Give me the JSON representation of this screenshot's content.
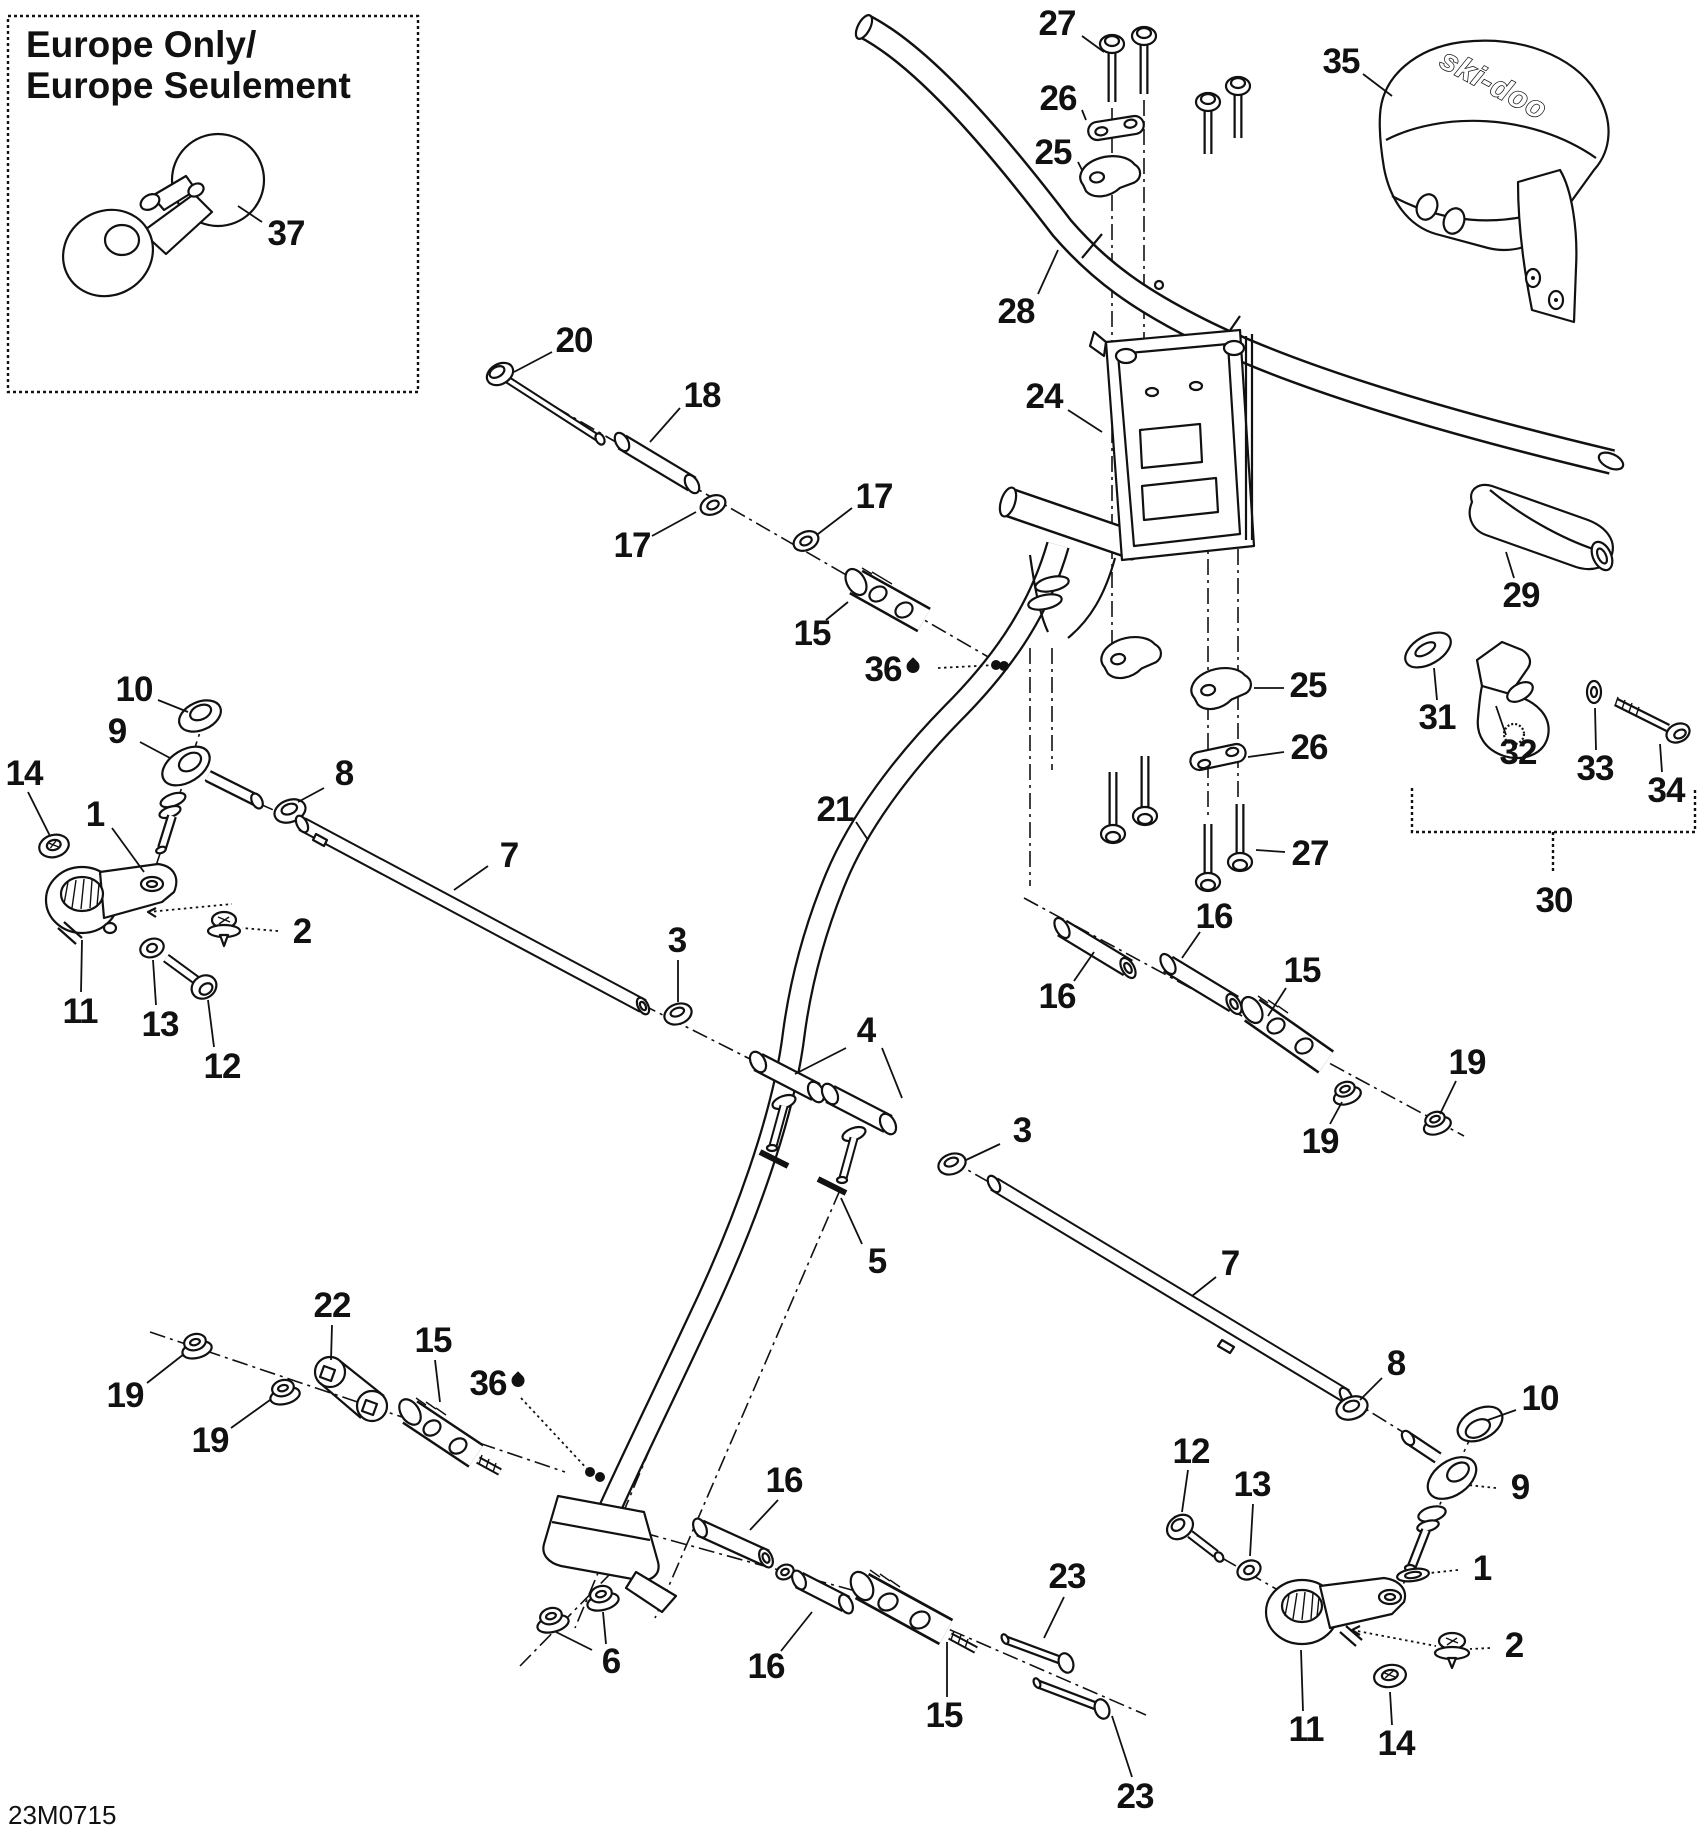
{
  "page": {
    "sheet_code": "23M0715"
  },
  "inset": {
    "title_line1": "Europe Only/",
    "title_line2": "Europe Seulement"
  },
  "cover": {
    "brand_text": "ski-doo"
  },
  "colors": {
    "ink": "#111111",
    "paper": "#ffffff"
  },
  "callouts": [
    {
      "n": "37",
      "x": 286,
      "y": 234,
      "lead": [
        262,
        222,
        238,
        206
      ]
    },
    {
      "n": "27",
      "x": 1057,
      "y": 24,
      "lead": [
        1082,
        36,
        1104,
        52
      ]
    },
    {
      "n": "26",
      "x": 1058,
      "y": 99,
      "lead": [
        1082,
        110,
        1086,
        120
      ]
    },
    {
      "n": "25",
      "x": 1053,
      "y": 153,
      "lead": [
        1078,
        162,
        1082,
        170
      ]
    },
    {
      "n": "28",
      "x": 1016,
      "y": 312,
      "lead": [
        1038,
        294,
        1058,
        250
      ]
    },
    {
      "n": "35",
      "x": 1341,
      "y": 62,
      "lead": [
        1363,
        74,
        1392,
        96
      ]
    },
    {
      "n": "24",
      "x": 1044,
      "y": 397,
      "lead": [
        1068,
        410,
        1102,
        432
      ]
    },
    {
      "n": "20",
      "x": 574,
      "y": 341,
      "lead": [
        552,
        352,
        514,
        372
      ]
    },
    {
      "n": "18",
      "x": 702,
      "y": 396,
      "lead": [
        680,
        408,
        650,
        442
      ]
    },
    {
      "n": "17",
      "x": 632,
      "y": 546,
      "lead": [
        652,
        536,
        696,
        512
      ]
    },
    {
      "n": "17",
      "x": 874,
      "y": 497,
      "lead": [
        852,
        508,
        818,
        534
      ]
    },
    {
      "n": "15",
      "x": 812,
      "y": 634,
      "lead": [
        826,
        620,
        848,
        602
      ]
    },
    {
      "n": "36",
      "x": 892,
      "y": 670,
      "drop": true,
      "dotted": true,
      "dot": true,
      "lead": [
        938,
        668,
        996,
        665
      ]
    },
    {
      "n": "21",
      "x": 835,
      "y": 810,
      "lead": [
        856,
        822,
        868,
        840
      ]
    },
    {
      "n": "29",
      "x": 1521,
      "y": 596,
      "lead": [
        1514,
        578,
        1506,
        552
      ]
    },
    {
      "n": "31",
      "x": 1437,
      "y": 718,
      "lead": [
        1437,
        700,
        1434,
        668
      ]
    },
    {
      "n": "32",
      "x": 1518,
      "y": 753,
      "lead": [
        1506,
        735,
        1496,
        706
      ]
    },
    {
      "n": "33",
      "x": 1595,
      "y": 769,
      "lead": [
        1596,
        750,
        1595,
        708
      ]
    },
    {
      "n": "34",
      "x": 1666,
      "y": 791,
      "lead": [
        1662,
        772,
        1660,
        744
      ]
    },
    {
      "n": "30",
      "x": 1554,
      "y": 901
    },
    {
      "n": "25",
      "x": 1308,
      "y": 686,
      "lead": [
        1284,
        688,
        1254,
        688
      ]
    },
    {
      "n": "26",
      "x": 1309,
      "y": 748,
      "lead": [
        1284,
        752,
        1248,
        757
      ]
    },
    {
      "n": "27",
      "x": 1310,
      "y": 854,
      "lead": [
        1285,
        852,
        1256,
        850
      ]
    },
    {
      "n": "16",
      "x": 1214,
      "y": 917,
      "lead": [
        1200,
        932,
        1182,
        958
      ]
    },
    {
      "n": "16",
      "x": 1057,
      "y": 997,
      "lead": [
        1074,
        981,
        1094,
        952
      ]
    },
    {
      "n": "15",
      "x": 1302,
      "y": 971,
      "lead": [
        1286,
        988,
        1268,
        1016
      ]
    },
    {
      "n": "19",
      "x": 1320,
      "y": 1142,
      "lead": [
        1330,
        1124,
        1342,
        1102
      ]
    },
    {
      "n": "19",
      "x": 1467,
      "y": 1063,
      "lead": [
        1456,
        1081,
        1440,
        1114
      ]
    },
    {
      "n": "7",
      "x": 509,
      "y": 856,
      "lead": [
        488,
        866,
        454,
        890
      ]
    },
    {
      "n": "3",
      "x": 677,
      "y": 941,
      "lead": [
        678,
        960,
        678,
        1002
      ]
    },
    {
      "n": "4",
      "x": 866,
      "y": 1031,
      "lead": [
        846,
        1048,
        795,
        1074
      ],
      "lead2": [
        882,
        1048,
        902,
        1098
      ]
    },
    {
      "n": "5",
      "x": 877,
      "y": 1262,
      "lead": [
        862,
        1244,
        841,
        1198
      ]
    },
    {
      "n": "3",
      "x": 1022,
      "y": 1131,
      "lead": [
        1000,
        1144,
        966,
        1160
      ]
    },
    {
      "n": "10",
      "x": 134,
      "y": 690,
      "lead": [
        158,
        700,
        188,
        712
      ]
    },
    {
      "n": "9",
      "x": 117,
      "y": 732,
      "lead": [
        140,
        742,
        170,
        758
      ]
    },
    {
      "n": "14",
      "x": 24,
      "y": 774,
      "lead": [
        28,
        792,
        50,
        836
      ]
    },
    {
      "n": "1",
      "x": 95,
      "y": 815,
      "lead": [
        112,
        828,
        144,
        872
      ]
    },
    {
      "n": "8",
      "x": 344,
      "y": 774,
      "lead": [
        324,
        788,
        298,
        802
      ]
    },
    {
      "n": "2",
      "x": 302,
      "y": 932,
      "dotted": true,
      "lead": [
        278,
        931,
        242,
        928
      ]
    },
    {
      "n": "11",
      "x": 80,
      "y": 1012,
      "lead": [
        81,
        992,
        82,
        940
      ]
    },
    {
      "n": "13",
      "x": 160,
      "y": 1025,
      "lead": [
        156,
        1005,
        153,
        960
      ]
    },
    {
      "n": "12",
      "x": 222,
      "y": 1067,
      "lead": [
        214,
        1047,
        208,
        1000
      ]
    },
    {
      "n": "19",
      "x": 125,
      "y": 1396,
      "lead": [
        147,
        1383,
        184,
        1354
      ]
    },
    {
      "n": "19",
      "x": 210,
      "y": 1441,
      "lead": [
        231,
        1428,
        270,
        1400
      ]
    },
    {
      "n": "22",
      "x": 332,
      "y": 1306,
      "lead": [
        332,
        1325,
        331,
        1360
      ]
    },
    {
      "n": "15",
      "x": 433,
      "y": 1341,
      "lead": [
        435,
        1360,
        440,
        1402
      ]
    },
    {
      "n": "36",
      "x": 497,
      "y": 1384,
      "drop": true,
      "dotted": true,
      "dot": true,
      "lead": [
        521,
        1398,
        590,
        1472
      ]
    },
    {
      "n": "16",
      "x": 784,
      "y": 1481,
      "lead": [
        778,
        1500,
        750,
        1530
      ]
    },
    {
      "n": "6",
      "x": 611,
      "y": 1662,
      "lead": [
        606,
        1644,
        603,
        1612
      ],
      "lead2": [
        592,
        1650,
        556,
        1632
      ]
    },
    {
      "n": "16",
      "x": 766,
      "y": 1667,
      "lead": [
        781,
        1651,
        812,
        1612
      ]
    },
    {
      "n": "15",
      "x": 944,
      "y": 1716,
      "lead": [
        947,
        1697,
        947,
        1642
      ]
    },
    {
      "n": "23",
      "x": 1067,
      "y": 1577,
      "lead": [
        1064,
        1597,
        1044,
        1638
      ]
    },
    {
      "n": "23",
      "x": 1135,
      "y": 1797,
      "lead": [
        1132,
        1777,
        1112,
        1716
      ]
    },
    {
      "n": "12",
      "x": 1191,
      "y": 1452,
      "lead": [
        1188,
        1470,
        1182,
        1512
      ]
    },
    {
      "n": "13",
      "x": 1252,
      "y": 1485,
      "lead": [
        1253,
        1504,
        1250,
        1556
      ]
    },
    {
      "n": "7",
      "x": 1230,
      "y": 1264,
      "lead": [
        1216,
        1277,
        1192,
        1296
      ]
    },
    {
      "n": "8",
      "x": 1396,
      "y": 1364,
      "lead": [
        1382,
        1378,
        1360,
        1400
      ]
    },
    {
      "n": "10",
      "x": 1540,
      "y": 1399,
      "lead": [
        1516,
        1410,
        1488,
        1420
      ]
    },
    {
      "n": "9",
      "x": 1520,
      "y": 1488,
      "dotted": true,
      "lead": [
        1496,
        1488,
        1468,
        1485
      ]
    },
    {
      "n": "1",
      "x": 1482,
      "y": 1569,
      "dotted": true,
      "lead": [
        1458,
        1570,
        1430,
        1573
      ]
    },
    {
      "n": "2",
      "x": 1514,
      "y": 1646,
      "dotted": true,
      "lead": [
        1490,
        1648,
        1470,
        1649
      ]
    },
    {
      "n": "11",
      "x": 1306,
      "y": 1730,
      "lead": [
        1303,
        1711,
        1301,
        1650
      ]
    },
    {
      "n": "14",
      "x": 1396,
      "y": 1744,
      "lead": [
        1392,
        1725,
        1390,
        1692
      ]
    }
  ]
}
